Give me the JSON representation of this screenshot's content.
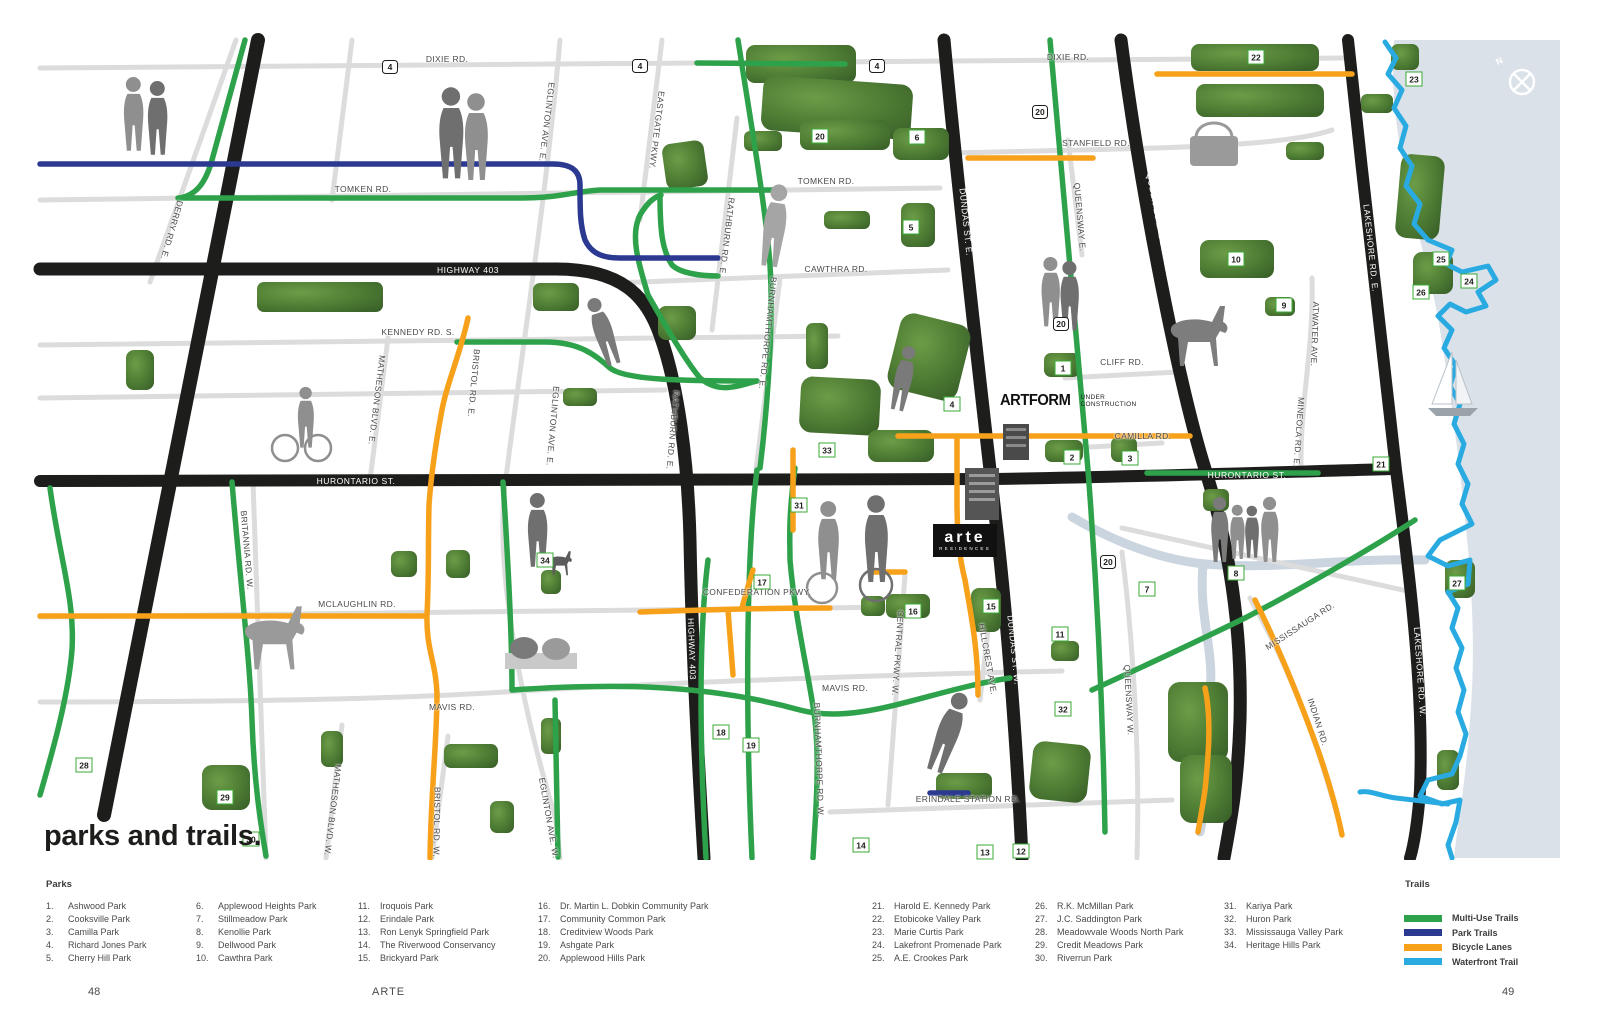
{
  "page": {
    "title": "parks and trails.",
    "footer_left": "48",
    "footer_center": "ARTE",
    "footer_right": "49"
  },
  "map": {
    "compass_label": "N",
    "artform": {
      "name": "ARTFORM",
      "status_line1": "UNDER",
      "status_line2": "CONSTRUCTION"
    },
    "arte_logo": {
      "name": "arte",
      "sub": "RESIDENCES"
    },
    "road_labels": [
      {
        "text": "DIXIE RD.",
        "x": 447,
        "y": 59,
        "rot": 0,
        "style": "dark"
      },
      {
        "text": "DIXIE RD.",
        "x": 1068,
        "y": 57,
        "rot": 0,
        "style": "dark"
      },
      {
        "text": "TOMKEN RD.",
        "x": 363,
        "y": 189,
        "rot": 0,
        "style": "dark"
      },
      {
        "text": "TOMKEN RD.",
        "x": 826,
        "y": 181,
        "rot": 0,
        "style": "dark"
      },
      {
        "text": "STANFIELD RD.",
        "x": 1096,
        "y": 143,
        "rot": 0,
        "style": "dark"
      },
      {
        "text": "CAWTHRA RD.",
        "x": 836,
        "y": 269,
        "rot": 0,
        "style": "dark"
      },
      {
        "text": "KENNEDY RD. S.",
        "x": 418,
        "y": 332,
        "rot": 0,
        "style": "dark"
      },
      {
        "text": "CLIFF RD.",
        "x": 1122,
        "y": 362,
        "rot": 0,
        "style": "dark"
      },
      {
        "text": "CAMILLA RD.",
        "x": 1143,
        "y": 436,
        "rot": 0,
        "style": "dark"
      },
      {
        "text": "MCLAUGHLIN RD.",
        "x": 357,
        "y": 604,
        "rot": 0,
        "style": "dark"
      },
      {
        "text": "CONFEDERATION PKWY.",
        "x": 757,
        "y": 592,
        "rot": 0,
        "style": "dark"
      },
      {
        "text": "MAVIS RD.",
        "x": 452,
        "y": 707,
        "rot": 0,
        "style": "dark"
      },
      {
        "text": "MAVIS RD.",
        "x": 845,
        "y": 688,
        "rot": 0,
        "style": "dark"
      },
      {
        "text": "ERINDALE STATION RD.",
        "x": 968,
        "y": 799,
        "rot": 0,
        "style": "dark"
      },
      {
        "text": "HIGHWAY 403",
        "x": 468,
        "y": 270,
        "rot": 0,
        "style": "white"
      },
      {
        "text": "HURONTARIO ST.",
        "x": 356,
        "y": 481,
        "rot": 0,
        "style": "white"
      },
      {
        "text": "HURONTARIO ST.",
        "x": 1247,
        "y": 475,
        "rot": 0,
        "style": "white"
      },
      {
        "text": "HIGHWAY 401",
        "x": 249,
        "y": 309,
        "rot": 101,
        "style": "white"
      },
      {
        "text": "HIGHWAY 403",
        "x": 692,
        "y": 649,
        "rot": 88,
        "style": "white"
      },
      {
        "text": "DUNDAS ST. E.",
        "x": 966,
        "y": 222,
        "rot": 84,
        "style": "white"
      },
      {
        "text": "DUNDAS ST. W.",
        "x": 1014,
        "y": 650,
        "rot": 84,
        "style": "white"
      },
      {
        "text": "QUEEN ELIZABETH WAY",
        "x": 1160,
        "y": 227,
        "rot": 79,
        "style": "white"
      },
      {
        "text": "LAKESHORE RD. E.",
        "x": 1371,
        "y": 248,
        "rot": 84,
        "style": "white"
      },
      {
        "text": "LAKESHORE RD. W.",
        "x": 1420,
        "y": 672,
        "rot": 86,
        "style": "white"
      },
      {
        "text": "DERRY RD. E.",
        "x": 172,
        "y": 230,
        "rot": 106,
        "style": "dark"
      },
      {
        "text": "EGLINTON AVE. E.",
        "x": 547,
        "y": 122,
        "rot": 97,
        "style": "dark"
      },
      {
        "text": "EASTGATE PKWY.",
        "x": 657,
        "y": 130,
        "rot": 97,
        "style": "dark"
      },
      {
        "text": "RATHBURN RD. E.",
        "x": 727,
        "y": 237,
        "rot": 97,
        "style": "dark"
      },
      {
        "text": "BURNHAMTHORPE RD. E.",
        "x": 768,
        "y": 333,
        "rot": 96,
        "style": "dark"
      },
      {
        "text": "MATHESON BLVD. E.",
        "x": 377,
        "y": 400,
        "rot": 97,
        "style": "dark"
      },
      {
        "text": "BRISTOL RD. E.",
        "x": 474,
        "y": 383,
        "rot": 95,
        "style": "dark"
      },
      {
        "text": "EGLINTON AVE. E.",
        "x": 553,
        "y": 426,
        "rot": 95,
        "style": "dark"
      },
      {
        "text": "RATHBURN RD. E.",
        "x": 673,
        "y": 430,
        "rot": 95,
        "style": "dark"
      },
      {
        "text": "QUEENSWAY E.",
        "x": 1080,
        "y": 217,
        "rot": 85,
        "style": "dark"
      },
      {
        "text": "ATWATER AVE.",
        "x": 1315,
        "y": 334,
        "rot": 92,
        "style": "dark"
      },
      {
        "text": "MINEOLA RD. E.",
        "x": 1299,
        "y": 432,
        "rot": 94,
        "style": "dark"
      },
      {
        "text": "BRITANNIA RD. W.",
        "x": 247,
        "y": 550,
        "rot": 85,
        "style": "dark"
      },
      {
        "text": "MATHESON BLVD. W.",
        "x": 333,
        "y": 810,
        "rot": 97,
        "style": "dark"
      },
      {
        "text": "BRISTOL RD. W.",
        "x": 437,
        "y": 822,
        "rot": 91,
        "style": "dark"
      },
      {
        "text": "EGLINTON AVE. W.",
        "x": 549,
        "y": 818,
        "rot": 80,
        "style": "dark"
      },
      {
        "text": "BURNHAMTHORPE RD. W.",
        "x": 819,
        "y": 760,
        "rot": 88,
        "style": "dark"
      },
      {
        "text": "CENTRAL PKWY. W.",
        "x": 898,
        "y": 653,
        "rot": 94,
        "style": "dark"
      },
      {
        "text": "HILLCREST AVE.",
        "x": 988,
        "y": 659,
        "rot": 80,
        "style": "dark"
      },
      {
        "text": "QUEENSWAY W.",
        "x": 1129,
        "y": 700,
        "rot": 87,
        "style": "dark"
      },
      {
        "text": "MISSISSAUGA RD.",
        "x": 1300,
        "y": 626,
        "rot": -33,
        "style": "dark"
      },
      {
        "text": "INDIAN RD.",
        "x": 1318,
        "y": 722,
        "rot": 72,
        "style": "dark"
      }
    ],
    "markers": [
      {
        "n": "1",
        "x": 1063,
        "y": 368,
        "t": "park"
      },
      {
        "n": "2",
        "x": 1072,
        "y": 457,
        "t": "park"
      },
      {
        "n": "3",
        "x": 1130,
        "y": 458,
        "t": "park"
      },
      {
        "n": "4",
        "x": 952,
        "y": 404,
        "t": "park"
      },
      {
        "n": "5",
        "x": 911,
        "y": 227,
        "t": "park"
      },
      {
        "n": "6",
        "x": 917,
        "y": 137,
        "t": "park"
      },
      {
        "n": "7",
        "x": 1147,
        "y": 589,
        "t": "park"
      },
      {
        "n": "8",
        "x": 1236,
        "y": 573,
        "t": "park"
      },
      {
        "n": "9",
        "x": 1284,
        "y": 305,
        "t": "park"
      },
      {
        "n": "10",
        "x": 1236,
        "y": 259,
        "t": "park"
      },
      {
        "n": "11",
        "x": 1060,
        "y": 634,
        "t": "park"
      },
      {
        "n": "12",
        "x": 1021,
        "y": 851,
        "t": "park"
      },
      {
        "n": "13",
        "x": 985,
        "y": 852,
        "t": "park"
      },
      {
        "n": "14",
        "x": 861,
        "y": 845,
        "t": "park"
      },
      {
        "n": "15",
        "x": 991,
        "y": 606,
        "t": "park"
      },
      {
        "n": "16",
        "x": 913,
        "y": 611,
        "t": "park"
      },
      {
        "n": "17",
        "x": 762,
        "y": 582,
        "t": "park"
      },
      {
        "n": "18",
        "x": 721,
        "y": 732,
        "t": "park"
      },
      {
        "n": "19",
        "x": 751,
        "y": 745,
        "t": "park"
      },
      {
        "n": "20",
        "x": 820,
        "y": 136,
        "t": "park"
      },
      {
        "n": "21",
        "x": 1381,
        "y": 464,
        "t": "park"
      },
      {
        "n": "22",
        "x": 1256,
        "y": 57,
        "t": "park"
      },
      {
        "n": "23",
        "x": 1414,
        "y": 79,
        "t": "park"
      },
      {
        "n": "24",
        "x": 1469,
        "y": 281,
        "t": "park"
      },
      {
        "n": "25",
        "x": 1441,
        "y": 259,
        "t": "park"
      },
      {
        "n": "26",
        "x": 1421,
        "y": 292,
        "t": "park"
      },
      {
        "n": "27",
        "x": 1457,
        "y": 583,
        "t": "park"
      },
      {
        "n": "28",
        "x": 84,
        "y": 765,
        "t": "park"
      },
      {
        "n": "29",
        "x": 225,
        "y": 797,
        "t": "park"
      },
      {
        "n": "30",
        "x": 251,
        "y": 839,
        "t": "park"
      },
      {
        "n": "31",
        "x": 799,
        "y": 505,
        "t": "park"
      },
      {
        "n": "32",
        "x": 1063,
        "y": 709,
        "t": "park"
      },
      {
        "n": "33",
        "x": 827,
        "y": 450,
        "t": "park"
      },
      {
        "n": "34",
        "x": 545,
        "y": 560,
        "t": "park"
      },
      {
        "n": "4",
        "x": 390,
        "y": 67,
        "t": "shield"
      },
      {
        "n": "4",
        "x": 640,
        "y": 66,
        "t": "shield"
      },
      {
        "n": "4",
        "x": 877,
        "y": 66,
        "t": "shield"
      },
      {
        "n": "20",
        "x": 1040,
        "y": 112,
        "t": "shield"
      },
      {
        "n": "20",
        "x": 1061,
        "y": 324,
        "t": "shield"
      },
      {
        "n": "20",
        "x": 1108,
        "y": 562,
        "t": "shield"
      }
    ]
  },
  "legend": {
    "parks_title": "Parks",
    "parks_columns": [
      {
        "x": 46,
        "items": [
          {
            "n": "1.",
            "name": "Ashwood Park"
          },
          {
            "n": "2.",
            "name": "Cooksville Park"
          },
          {
            "n": "3.",
            "name": "Camilla Park"
          },
          {
            "n": "4.",
            "name": "Richard Jones Park"
          },
          {
            "n": "5.",
            "name": "Cherry Hill Park"
          }
        ]
      },
      {
        "x": 196,
        "items": [
          {
            "n": "6.",
            "name": "Applewood Heights Park"
          },
          {
            "n": "7.",
            "name": "Stillmeadow Park"
          },
          {
            "n": "8.",
            "name": "Kenollie Park"
          },
          {
            "n": "9.",
            "name": "Dellwood Park"
          },
          {
            "n": "10.",
            "name": "Cawthra Park"
          }
        ]
      },
      {
        "x": 358,
        "items": [
          {
            "n": "11.",
            "name": "Iroquois Park"
          },
          {
            "n": "12.",
            "name": "Erindale Park"
          },
          {
            "n": "13.",
            "name": "Ron Lenyk Springfield Park"
          },
          {
            "n": "14.",
            "name": "The Riverwood Conservancy"
          },
          {
            "n": "15.",
            "name": "Brickyard Park"
          }
        ]
      },
      {
        "x": 538,
        "items": [
          {
            "n": "16.",
            "name": "Dr. Martin L. Dobkin Community Park"
          },
          {
            "n": "17.",
            "name": "Community Common Park"
          },
          {
            "n": "18.",
            "name": "Creditview Woods Park"
          },
          {
            "n": "19.",
            "name": "Ashgate Park"
          },
          {
            "n": "20.",
            "name": "Applewood Hills Park"
          }
        ]
      },
      {
        "x": 872,
        "items": [
          {
            "n": "21.",
            "name": "Harold E. Kennedy Park"
          },
          {
            "n": "22.",
            "name": "Etobicoke Valley Park"
          },
          {
            "n": "23.",
            "name": "Marie Curtis Park"
          },
          {
            "n": "24.",
            "name": "Lakefront Promenade Park"
          },
          {
            "n": "25.",
            "name": "A.E. Crookes Park"
          }
        ]
      },
      {
        "x": 1035,
        "items": [
          {
            "n": "26.",
            "name": "R.K. McMillan Park"
          },
          {
            "n": "27.",
            "name": "J.C. Saddington Park"
          },
          {
            "n": "28.",
            "name": "Meadowvale Woods North Park"
          },
          {
            "n": "29.",
            "name": "Credit Meadows Park"
          },
          {
            "n": "30.",
            "name": "Riverrun Park"
          }
        ]
      },
      {
        "x": 1224,
        "items": [
          {
            "n": "31.",
            "name": "Kariya Park"
          },
          {
            "n": "32.",
            "name": "Huron Park"
          },
          {
            "n": "33.",
            "name": "Mississauga Valley Park"
          },
          {
            "n": "34.",
            "name": "Heritage Hills Park"
          }
        ]
      }
    ],
    "trails_title": "Trails",
    "trails": [
      {
        "label": "Multi-Use Trails",
        "color": "#2ea24b"
      },
      {
        "label": "Park Trails",
        "color": "#2b3990"
      },
      {
        "label": "Bicycle Lanes",
        "color": "#f7a11a"
      },
      {
        "label": "Waterfront Trail",
        "color": "#29abe2"
      }
    ]
  },
  "colors": {
    "multi_use": "#2ea24b",
    "park_trail": "#2b3990",
    "bicycle": "#f7a11a",
    "waterfront": "#29abe2",
    "lake": "#dae1e9",
    "road_minor": "#dcdcdc",
    "road_major": "#1d1d1b",
    "marker_border": "#3aa935"
  }
}
